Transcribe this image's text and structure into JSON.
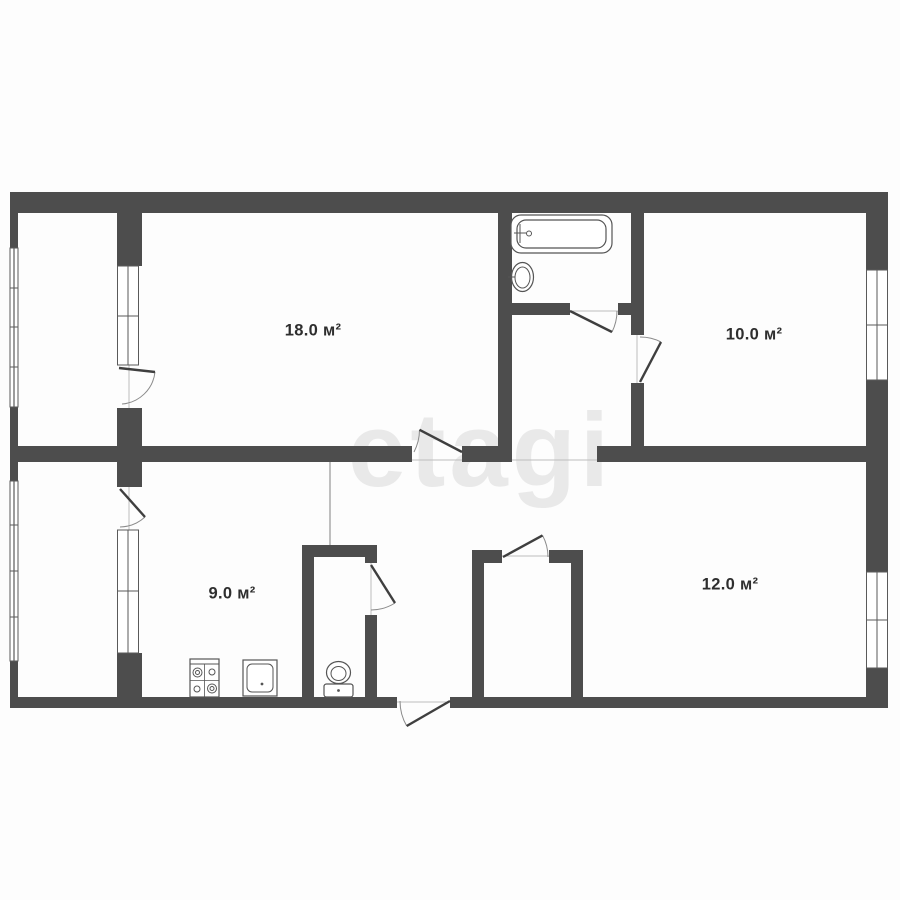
{
  "watermark": {
    "text": "etagi",
    "color": "#e9e9e9"
  },
  "palette": {
    "wall": "#4d4d4d",
    "fixture_stroke": "#555555",
    "door_leaf": "#3f3f3f",
    "door_arc": "#8a8a8a",
    "threshold": "#bdbdbd",
    "window_line": "#5a5a5a",
    "label": "#2e2e2e",
    "background": "#fdfdfd"
  },
  "rooms": [
    {
      "id": "living-room",
      "area_label": "18.0 м²"
    },
    {
      "id": "bedroom",
      "area_label": "10.0 м²"
    },
    {
      "id": "kitchen",
      "area_label": "9.0 м²"
    },
    {
      "id": "second-room",
      "area_label": "12.0 м²"
    }
  ],
  "fixtures": [
    {
      "name": "bathtub-icon"
    },
    {
      "name": "bathroom-sink-icon"
    },
    {
      "name": "toilet-icon"
    },
    {
      "name": "stove-icon"
    },
    {
      "name": "kitchen-sink-icon"
    }
  ]
}
